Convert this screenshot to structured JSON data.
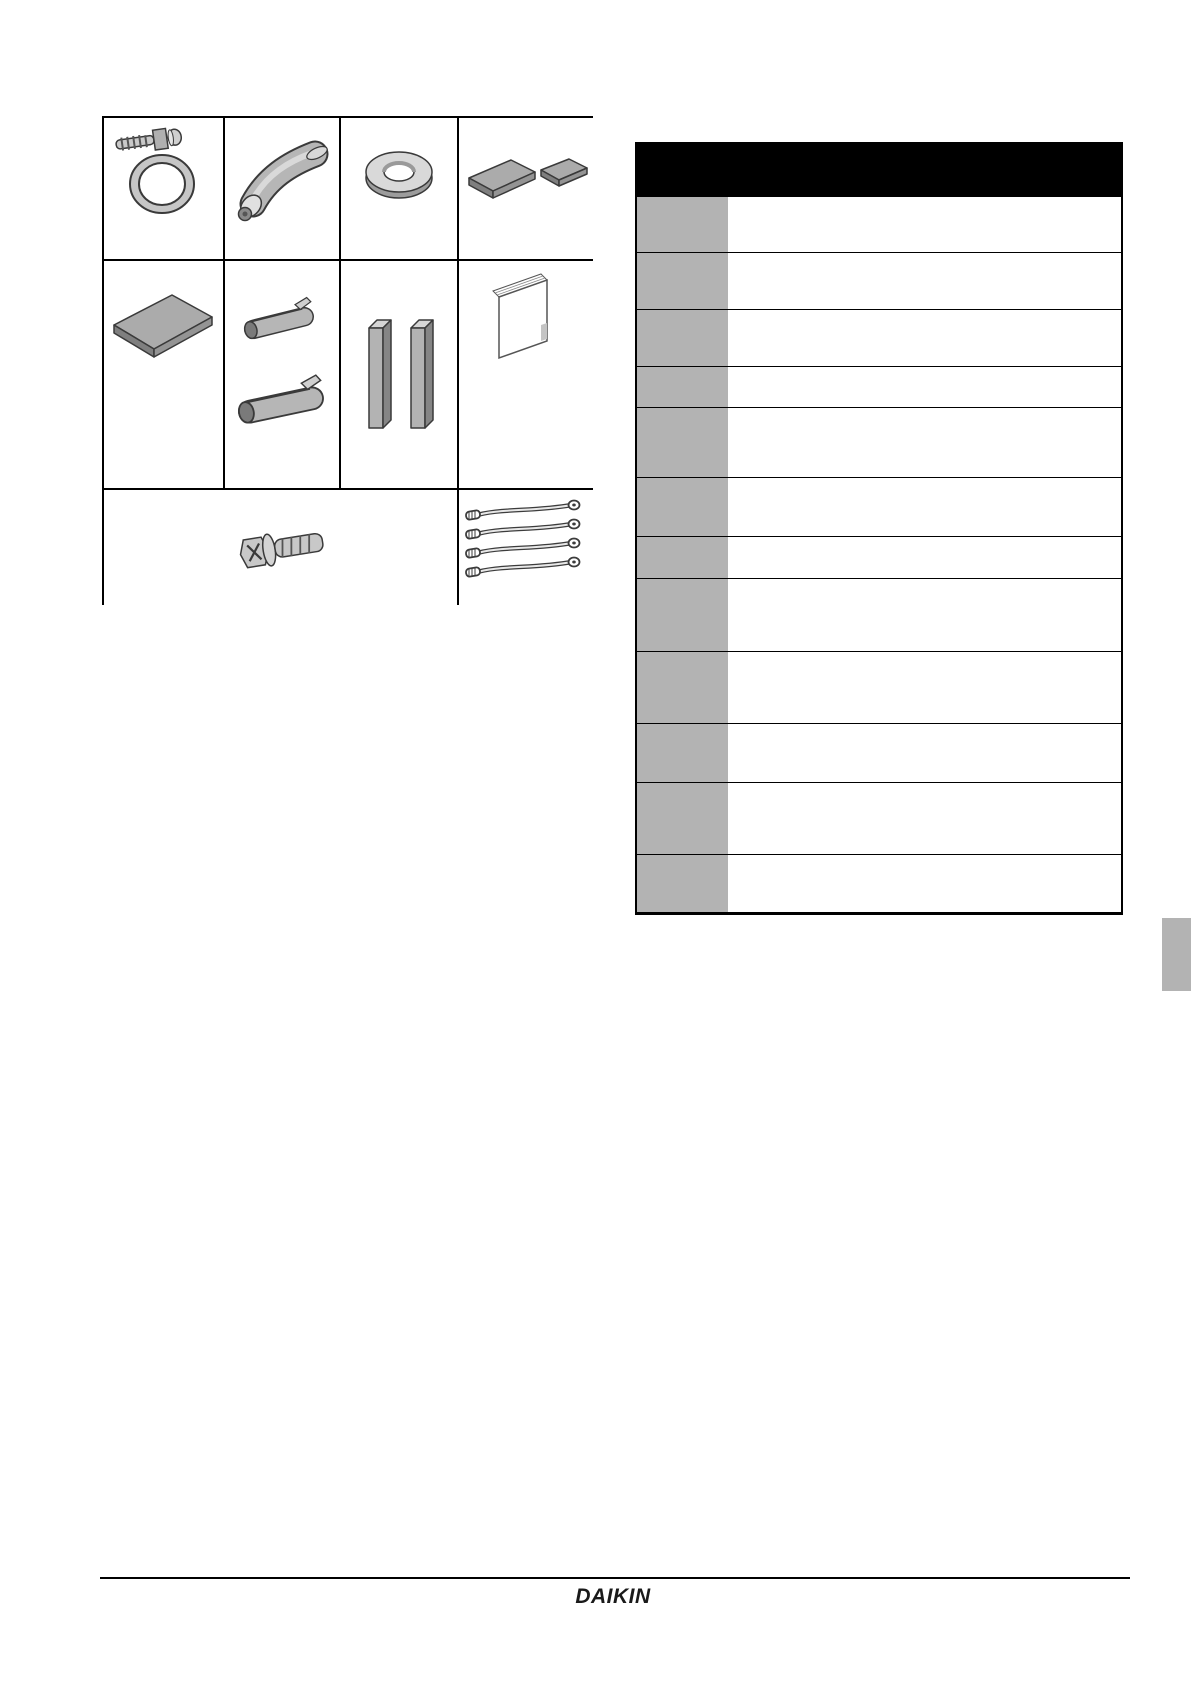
{
  "page": {
    "footer": {
      "logo_text": "DAIKIN"
    }
  },
  "accessories_grid": {
    "items": [
      {
        "icon": "hose-clamp-icon",
        "label": ""
      },
      {
        "icon": "insulation-tube-icon",
        "label": ""
      },
      {
        "icon": "washer-icon",
        "label": ""
      },
      {
        "icon": "sealing-pads-icon",
        "label": ""
      },
      {
        "icon": "insulation-sheet-icon",
        "label": ""
      },
      {
        "icon": "pipe-insulation-clips-icon",
        "label": ""
      },
      {
        "icon": "foam-bars-icon",
        "label": ""
      },
      {
        "icon": "installation-manual-icon",
        "label": ""
      },
      {
        "icon": "flange-screw-icon",
        "label": ""
      },
      {
        "icon": "cable-ties-icon",
        "label": ""
      }
    ]
  },
  "parts_table": {
    "header_text": "",
    "rows": [
      {
        "code": "",
        "description": ""
      },
      {
        "code": "",
        "description": ""
      },
      {
        "code": "",
        "description": ""
      },
      {
        "code": "",
        "description": ""
      },
      {
        "code": "",
        "description": ""
      },
      {
        "code": "",
        "description": ""
      },
      {
        "code": "",
        "description": ""
      },
      {
        "code": "",
        "description": ""
      },
      {
        "code": "",
        "description": ""
      },
      {
        "code": "",
        "description": ""
      },
      {
        "code": "",
        "description": ""
      },
      {
        "code": "",
        "description": ""
      }
    ]
  },
  "section_tab": {
    "text": ""
  },
  "colors": {
    "table_header_bg": "#000000",
    "table_code_cell_bg": "#b3b3b3",
    "section_tab_bg": "#b3b3b3",
    "line_color": "#000000",
    "logo_color": "#1a1a1a"
  }
}
